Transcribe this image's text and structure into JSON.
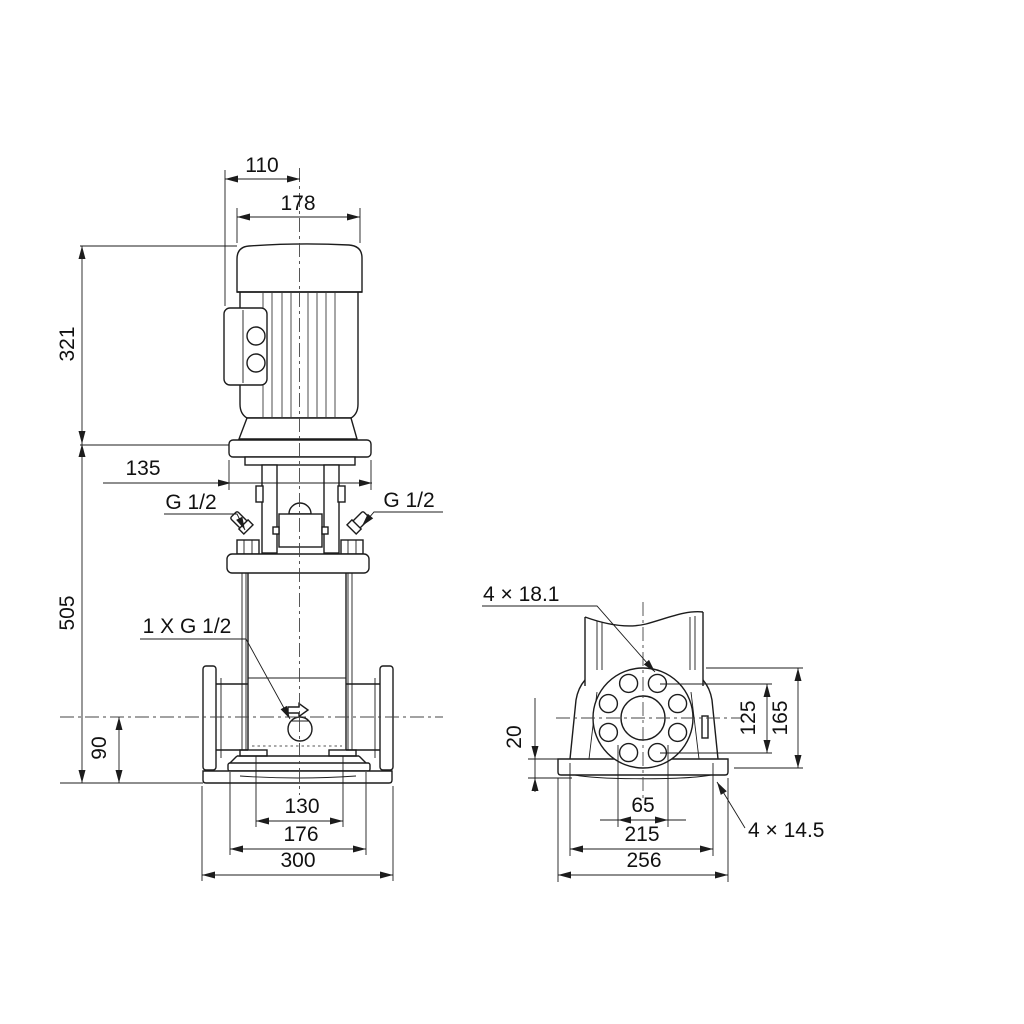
{
  "drawing": {
    "front_view": {
      "dims": {
        "motor_offset": "110",
        "motor_width": "178",
        "motor_height": "321",
        "head_width": "135",
        "pump_height": "505",
        "port_height": "90",
        "base_inner": "130",
        "base_mid": "176",
        "port_span": "300"
      },
      "labels": {
        "vent_left": "G 1/2",
        "vent_right": "G 1/2",
        "drain": "1 X G 1/2"
      }
    },
    "side_view": {
      "dims": {
        "base_plate_height": "20",
        "bolt_circle": "125",
        "flange_od": "165",
        "port_bore": "65",
        "base_bolt_span": "215",
        "base_width": "256"
      },
      "labels": {
        "flange_holes": "4 × 18.1",
        "base_holes": "4 × 14.5"
      }
    }
  }
}
